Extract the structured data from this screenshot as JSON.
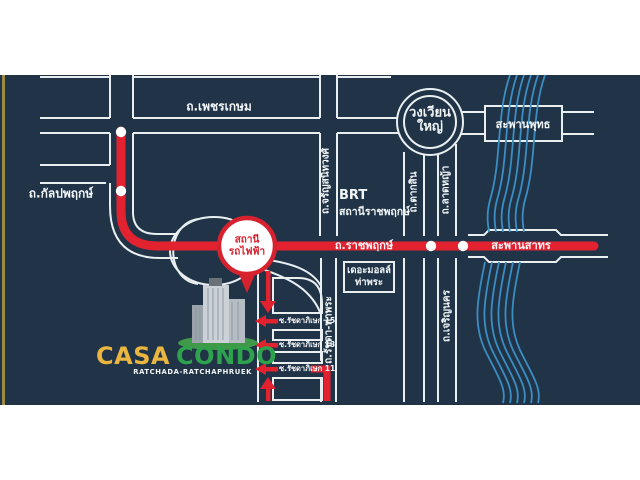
{
  "map": {
    "roads": {
      "phetkasem": "ถ.เพชรเกษม",
      "kalpaphruek": "ถ.กัลปพฤกษ์",
      "charansanitwong": "ถ.จรัญสนิทวงศ์",
      "ratchaphruek": "ถ.ราชพฤกษ์",
      "taksin": "ถ.ตากสิน",
      "latya": "ถ.ลาดหญ้า",
      "charoen_nakhon": "ถ.เจริญนคร",
      "ratchada_thaphra": "ถ.รัชดา-ท่าพระ"
    },
    "bridges": {
      "saphan_phut": "สะพานพุทธ",
      "saphan_sathorn": "สะพานสาทร"
    },
    "landmarks": {
      "wongwian_yai": {
        "line1": "วงเวียน",
        "line2": "ใหญ่"
      },
      "brt": {
        "line1": "BRT",
        "line2": "สถานีราชพฤกษ์"
      },
      "the_mall": {
        "line1": "เดอะมอลล์",
        "line2": "ท่าพระ"
      },
      "train_station": {
        "line1": "สถานี",
        "line2": "รถไฟฟ้า"
      }
    },
    "sois": [
      "ซ.รัชดาภิเษก 15",
      "ซ.รัชดาภิเษก 13",
      "ซ.รัชดาภิเษก 11"
    ],
    "brand": {
      "name_part1": "CASA",
      "name_part2": "CONDO",
      "subtitle": "RATCHADA-RATCHAPHRUEK"
    },
    "colors": {
      "background": "#213447",
      "route_red": "#e32230",
      "river_blue": "#3a8ec2",
      "road_line": "#e9eef1",
      "brand_yellow": "#eab640",
      "brand_green": "#2fa24d"
    }
  }
}
